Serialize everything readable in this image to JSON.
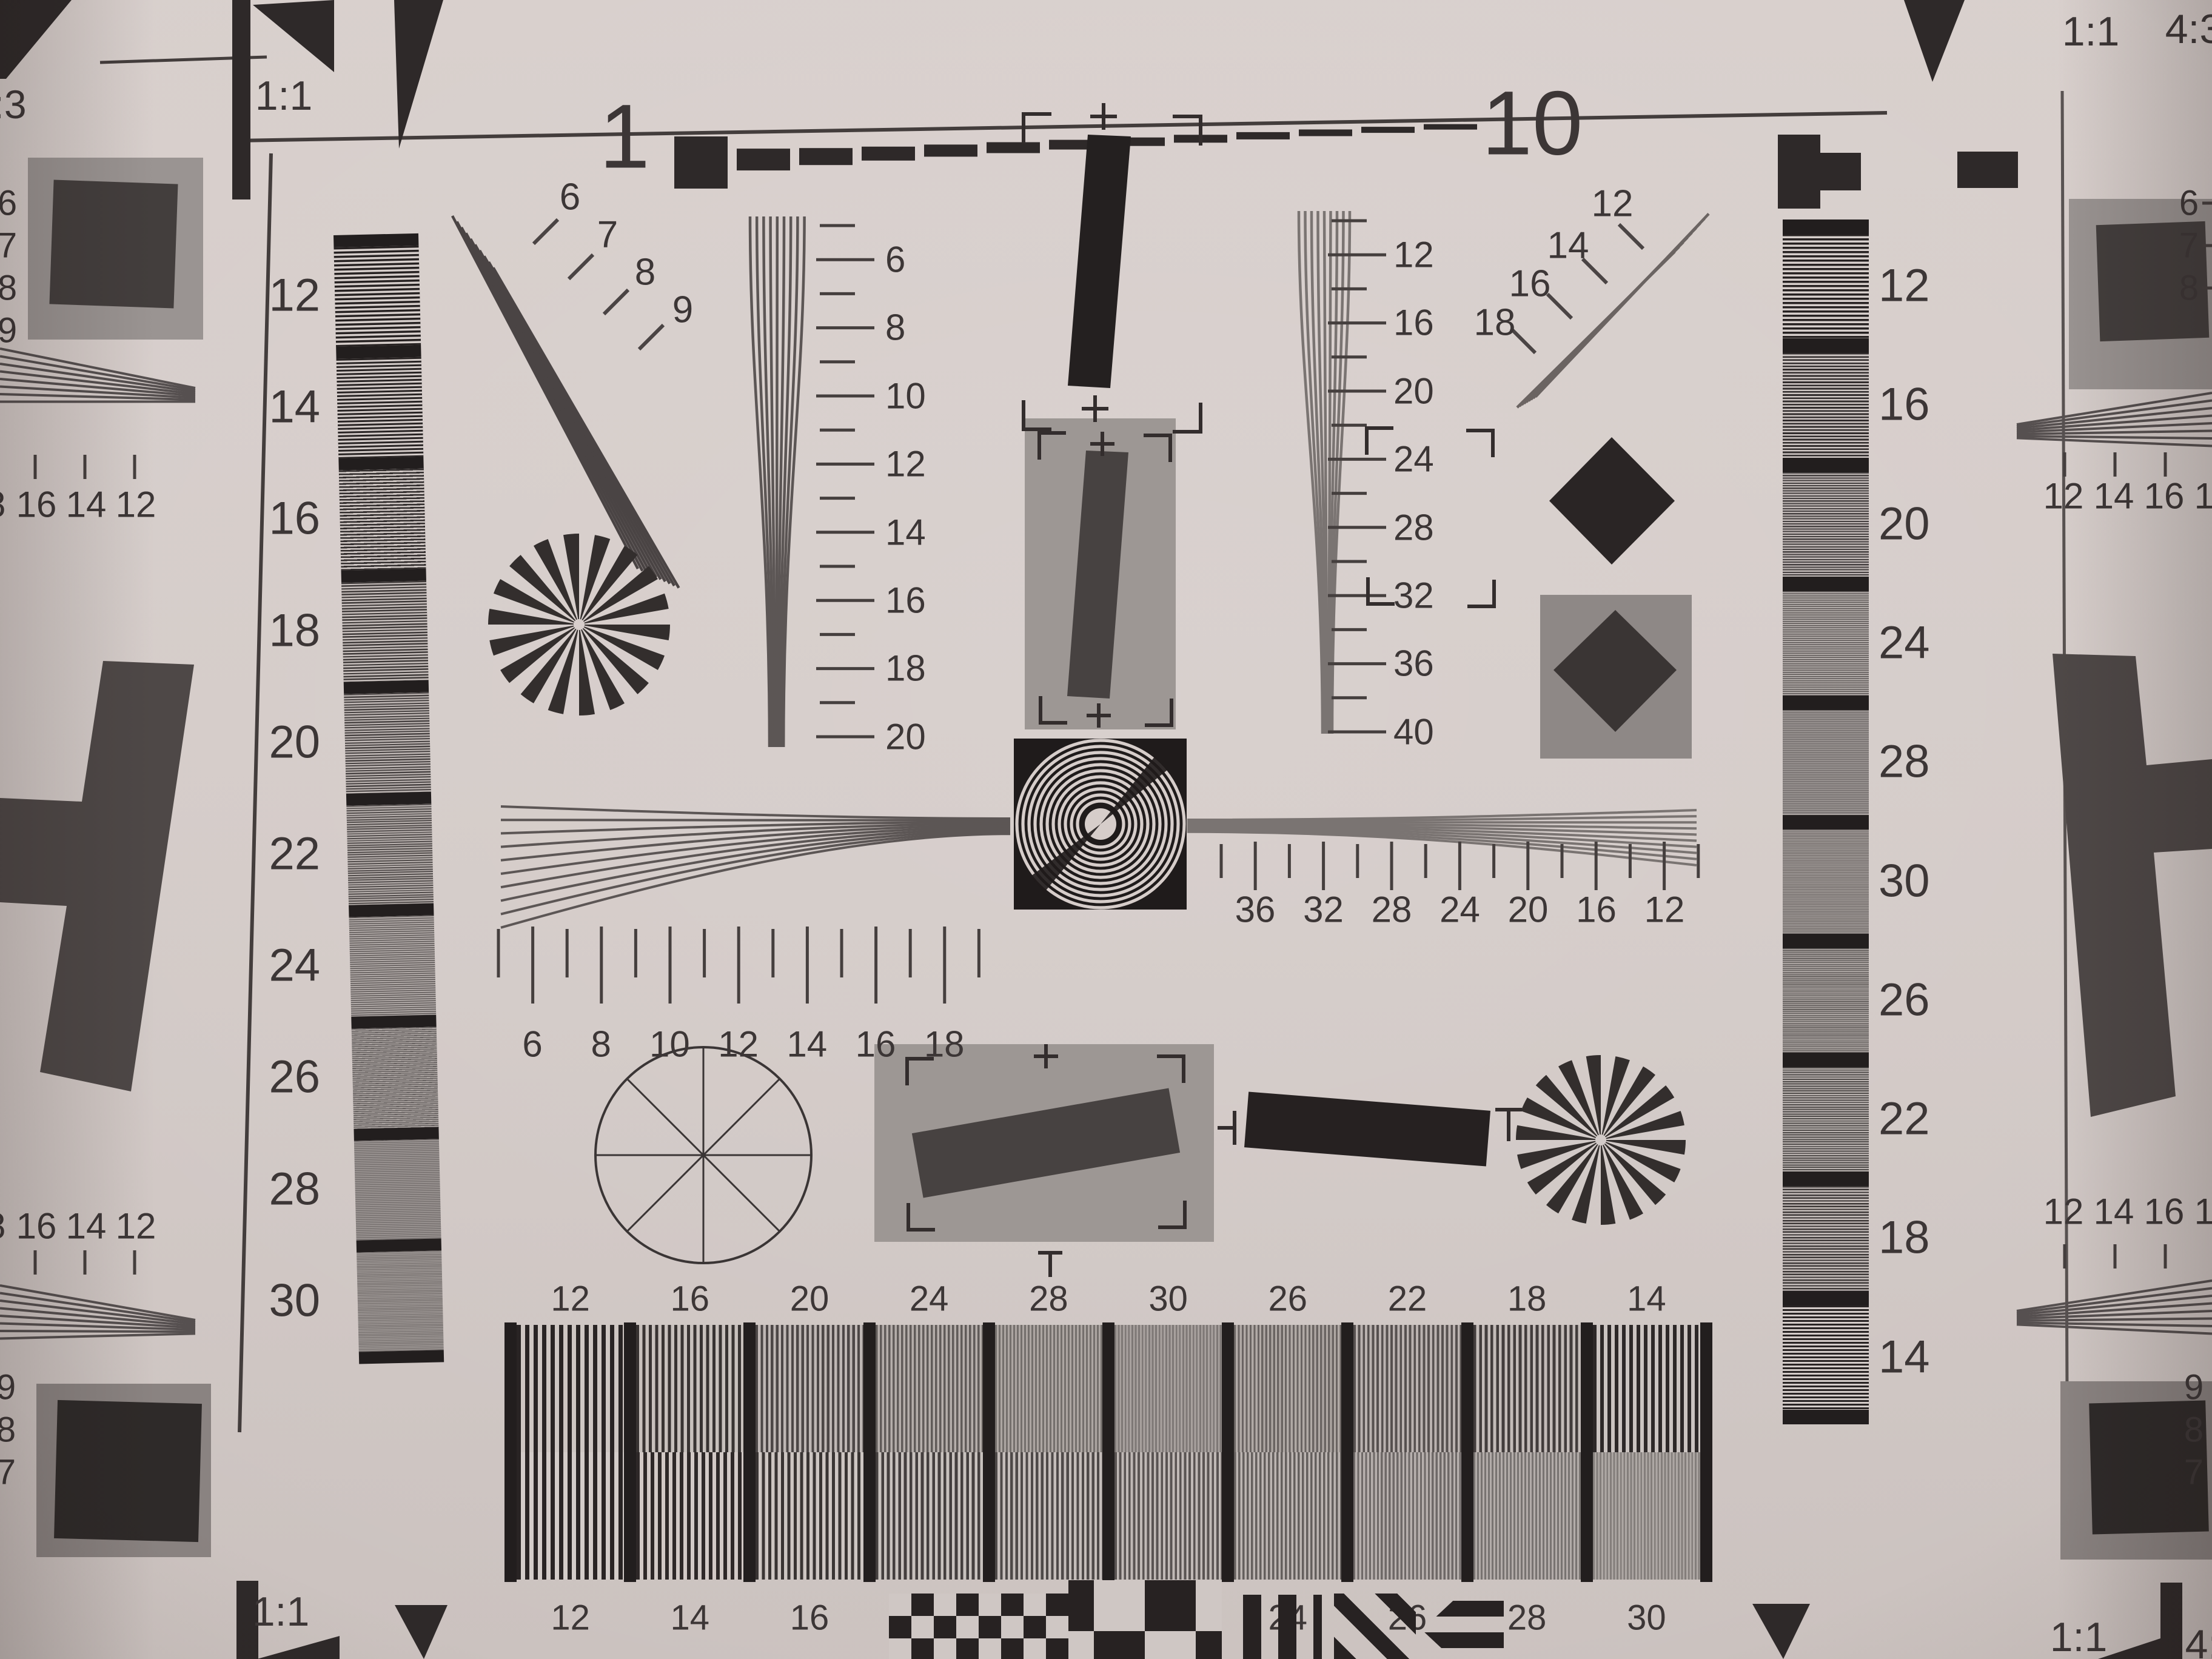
{
  "colors": {
    "paper": "#d4cbc8",
    "ink": "#2e2929",
    "mid_gray": "#5c5655",
    "strip_gray": "#8f8987",
    "square_gray": "#9d9794",
    "dark_bar": "#474241",
    "black_square": "#1f1b1b",
    "h_shape": "#4e4847"
  },
  "markers": {
    "top_left_aspect_partial": ":3",
    "top_left_ratio": "1:1",
    "top_right_ratio": "1:1",
    "top_right_aspect": "4:3",
    "bottom_left_ratio": "1:1",
    "bottom_right_ratio": "1:1",
    "bottom_right_aspect_partial": "4:"
  },
  "ruler": {
    "left": "1",
    "right": "10"
  },
  "fan_top_left": {
    "labels": [
      "6",
      "7",
      "8",
      "9"
    ]
  },
  "fan_top_right": {
    "labels": [
      "12",
      "14",
      "16",
      "18"
    ]
  },
  "wedge_left": {
    "labels": [
      "6",
      "8",
      "10",
      "12",
      "14",
      "16",
      "18",
      "20"
    ]
  },
  "wedge_right": {
    "labels": [
      "12",
      "16",
      "20",
      "24",
      "28",
      "32",
      "36",
      "40"
    ]
  },
  "hscale_left": {
    "labels": [
      "6",
      "8",
      "10",
      "12",
      "14",
      "16",
      "18"
    ]
  },
  "hscale_right": {
    "labels": [
      "36",
      "32",
      "28",
      "24",
      "20",
      "16",
      "12"
    ]
  },
  "strip_left": {
    "labels": [
      "12",
      "14",
      "16",
      "18",
      "20",
      "22",
      "24",
      "26",
      "28",
      "30"
    ]
  },
  "strip_right": {
    "labels": [
      "12",
      "16",
      "20",
      "24",
      "28",
      "30",
      "26",
      "22",
      "18",
      "14"
    ]
  },
  "bottom_block": {
    "top_labels": [
      "12",
      "16",
      "20",
      "24",
      "28",
      "30",
      "26",
      "22",
      "18",
      "14"
    ],
    "bottom_labels": [
      "12",
      "14",
      "16",
      "18",
      "20",
      "22",
      "24",
      "26",
      "28",
      "30"
    ]
  },
  "edge_top_left": {
    "scale": [
      "18",
      "16",
      "14",
      "12"
    ],
    "numbers": [
      "6",
      "7",
      "8",
      "9"
    ]
  },
  "edge_bottom_left": {
    "scale": [
      "18",
      "16",
      "14",
      "12"
    ],
    "numbers": [
      "9",
      "8",
      "7"
    ]
  },
  "edge_top_right": {
    "scale": [
      "12",
      "14",
      "16",
      "18"
    ],
    "numbers": [
      "6",
      "7",
      "8"
    ]
  },
  "edge_bottom_right": {
    "scale": [
      "12",
      "14",
      "16",
      "18"
    ],
    "numbers": [
      "9",
      "8",
      "7"
    ]
  }
}
